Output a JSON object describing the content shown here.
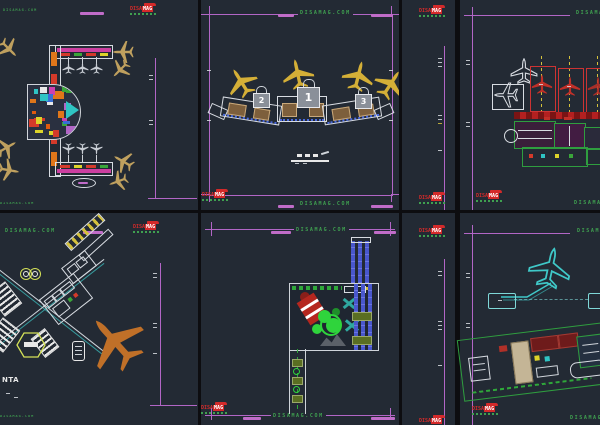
{
  "brand": {
    "watermark": "DISAMAG.COM",
    "logo": {
      "line1": "DISA",
      "line2": "MAG"
    }
  },
  "colors": {
    "panel_background": "#232a34",
    "divider": "#0d0d10",
    "sheet_frame_magenta": "#b266c6",
    "watermark_green": "#3fa050",
    "logo_red": "#d42a2a",
    "plane_tan": "#bfa05e",
    "plane_yellow": "#d4af37",
    "plane_cyan": "#3fc8c8",
    "plane_orange": "#c07028",
    "plane_red": "#c03028",
    "plane_gray": "#c8cdd4",
    "hub_palette": [
      "#e0761a",
      "#d43a2a",
      "#cc3fb0",
      "#2fc4c4",
      "#ddd32a",
      "#3aa53a",
      "#3a6fd4",
      "#e8e8e8",
      "#b266c6",
      "#e05a10"
    ]
  },
  "panels": {
    "top_middle": {
      "gates": [
        "2",
        "1",
        "3"
      ]
    },
    "bottom_left": {
      "caption": "NTA"
    }
  }
}
